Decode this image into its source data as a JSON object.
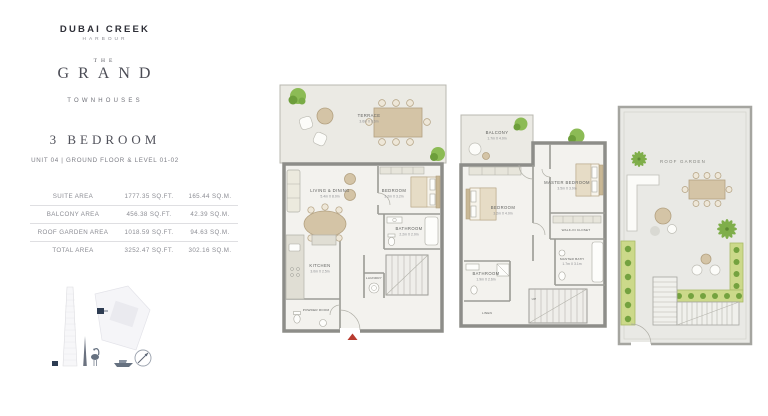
{
  "brand": {
    "name": "DUBAI CREEK",
    "tagline": "HARBOUR",
    "collection_the": "THE",
    "collection_name": "GRAND",
    "collection_type": "TOWNHOUSES"
  },
  "unit": {
    "title": "3 BEDROOM",
    "subtitle": "UNIT 04 | GROUND FLOOR & LEVEL 01-02"
  },
  "area_table": {
    "rows": [
      {
        "label": "SUITE AREA",
        "sqft": "1777.35 SQ.FT.",
        "sqm": "165.44 SQ.M."
      },
      {
        "label": "BALCONY AREA",
        "sqft": "456.38 SQ.FT.",
        "sqm": "42.39 SQ.M."
      },
      {
        "label": "ROOF GARDEN AREA",
        "sqft": "1018.59 SQ.FT.",
        "sqm": "94.63 SQ.M."
      },
      {
        "label": "TOTAL AREA",
        "sqft": "3252.47 SQ.FT.",
        "sqm": "302.16 SQ.M."
      }
    ]
  },
  "plans": {
    "ground": {
      "terrace": {
        "label": "TERRACE",
        "dims": "3.6m X 8.6m"
      },
      "living": {
        "label": "LIVING & DINING",
        "dims": "5.4m X 8.0m"
      },
      "bedroom": {
        "label": "BEDROOM",
        "dims": "3.2m X 3.2m"
      },
      "bathroom": {
        "label": "BATHROOM",
        "dims": "2.2m X 2.0m"
      },
      "kitchen": {
        "label": "KITCHEN",
        "dims": "3.0m X 2.5m"
      },
      "powder": {
        "label": "POWDER ROOM"
      },
      "laundry": {
        "label": "LAUNDRY"
      }
    },
    "level1": {
      "balcony": {
        "label": "BALCONY",
        "dims": "1.7m X 4.0m"
      },
      "bedroom": {
        "label": "BEDROOM",
        "dims": "3.2m X 4.0m"
      },
      "master": {
        "label": "MASTER BEDROOM",
        "dims": "3.5m X 3.9m"
      },
      "walkin": {
        "label": "WALK-IN CLOSET"
      },
      "bathroom": {
        "label": "BATHROOM",
        "dims": "1.9m X 2.6m"
      },
      "masterbath": {
        "label": "MASTER BATH",
        "dims": "1.7m X 3.1m"
      },
      "linen": {
        "label": "LINEN"
      },
      "stair": {
        "label": "UP"
      }
    },
    "roof": {
      "garden": {
        "label": "ROOF GARDEN"
      }
    }
  },
  "colors": {
    "accent_red": "#b83b2f",
    "plant_green": "#7fae4a",
    "planter_green": "#ccd98a",
    "wall_gray": "#8d8d89"
  }
}
